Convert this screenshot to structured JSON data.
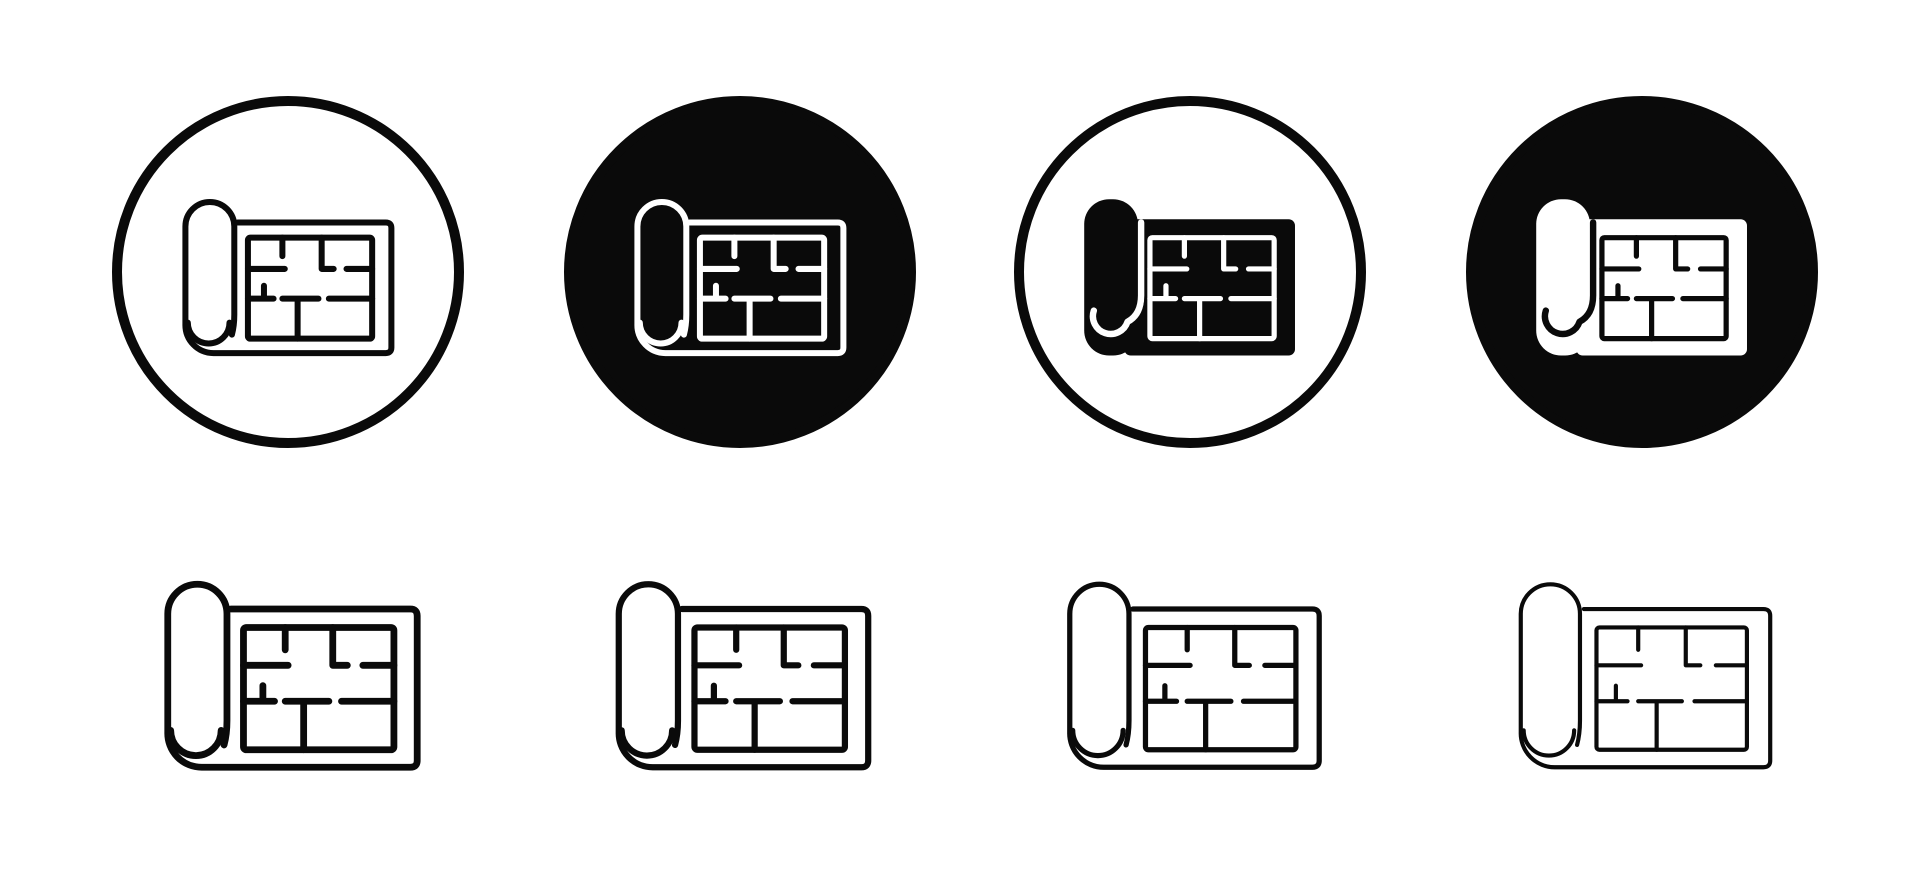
{
  "page": {
    "title": "Floor plan blueprint icon set",
    "background": "#ffffff",
    "glyph": "blueprint-floor-plan-roll",
    "grid": {
      "columns": 4,
      "rows": 2
    }
  },
  "colors": {
    "ink": "#0a0a0a",
    "paper": "#ffffff"
  },
  "icon_set": {
    "top_row": [
      {
        "id": "badge-outlined-circle-line",
        "container": "outlined-circle",
        "style": "line",
        "foreground": "#0a0a0a",
        "background": "#ffffff",
        "icon_stroke_weight": 7.5
      },
      {
        "id": "badge-filled-circle-line",
        "container": "filled-circle",
        "style": "line",
        "foreground": "#ffffff",
        "background": "#0a0a0a",
        "icon_stroke_weight": 7.5
      },
      {
        "id": "badge-outlined-circle-solid",
        "container": "outlined-circle",
        "style": "solid",
        "foreground": "#0a0a0a",
        "background": "#ffffff",
        "icon_stroke_weight": 7.5
      },
      {
        "id": "badge-filled-circle-solid",
        "container": "filled-circle",
        "style": "solid",
        "foreground": "#ffffff",
        "background": "#0a0a0a",
        "icon_stroke_weight": 7.5
      }
    ],
    "bottom_row": [
      {
        "id": "line-bold",
        "style": "line",
        "foreground": "#0a0a0a",
        "background": "#ffffff",
        "stroke_weight": 7
      },
      {
        "id": "line-regular",
        "style": "line",
        "foreground": "#0a0a0a",
        "background": "#ffffff",
        "stroke_weight": 6.4
      },
      {
        "id": "line-light",
        "style": "line",
        "foreground": "#0a0a0a",
        "background": "#ffffff",
        "stroke_weight": 5.4
      },
      {
        "id": "line-thin",
        "style": "line",
        "foreground": "#0a0a0a",
        "background": "#ffffff",
        "stroke_weight": 4.3
      }
    ]
  }
}
